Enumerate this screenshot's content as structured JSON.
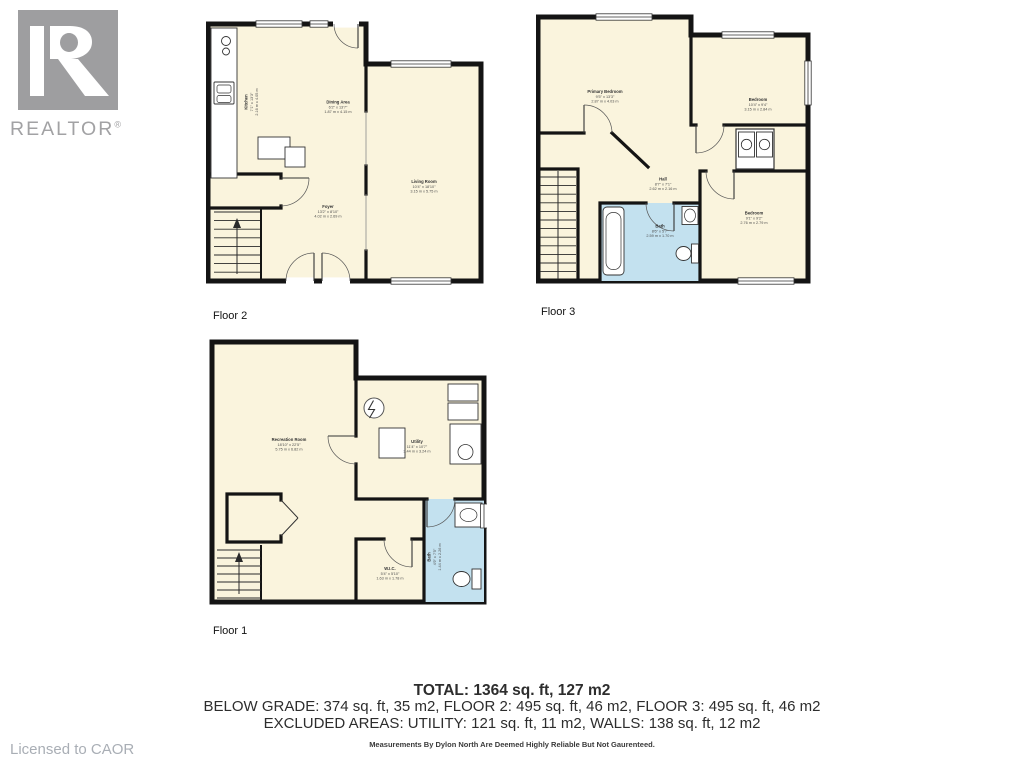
{
  "branding": {
    "logo_text": "REALTOR",
    "logo_reg": "®",
    "licensed": "Licensed to CAOR"
  },
  "floors": {
    "floor2": {
      "label": "Floor 2",
      "rooms": {
        "kitchen": {
          "name": "Kitchen",
          "ft": "7'1\" x 13'3\"",
          "m": "2.16 m x 4.05 m"
        },
        "dining": {
          "name": "Dining Area",
          "ft": "6'2\" x 13'7\"",
          "m": "1.87 m x 4.15 m"
        },
        "living": {
          "name": "Living Room",
          "ft": "10'4\" x 18'10\"",
          "m": "3.15 m x 5.75 m"
        },
        "foyer": {
          "name": "Foyer",
          "ft": "13'2\" x 8'10\"",
          "m": "4.02 m x 2.69 m"
        }
      }
    },
    "floor3": {
      "label": "Floor 3",
      "rooms": {
        "primary": {
          "name": "Primary Bedroom",
          "ft": "9'5\" x 13'3\"",
          "m": "2.87 m x 4.03 m"
        },
        "bedroom2": {
          "name": "Bedroom",
          "ft": "10'4\" x 9'4\"",
          "m": "3.15 m x 2.84 m"
        },
        "hall": {
          "name": "Hall",
          "ft": "8'7\" x 7'1\"",
          "m": "2.62 m x 2.16 m"
        },
        "bath": {
          "name": "Bath",
          "ft": "8'6\" x 5'7\"",
          "m": "2.59 m x 1.70 m"
        },
        "bedroom3": {
          "name": "Bedroom",
          "ft": "9'1\" x 9'2\"",
          "m": "2.76 m x 2.79 m"
        }
      }
    },
    "floor1": {
      "label": "Floor 1",
      "rooms": {
        "rec": {
          "name": "Recreation Room",
          "ft": "18'10\" x 22'5\"",
          "m": "5.75 m x 6.82 m"
        },
        "utility": {
          "name": "Utility",
          "ft": "11'4\" x 10'7\"",
          "m": "3.44 m x 3.24 m"
        },
        "wic": {
          "name": "W.I.C.",
          "ft": "5'4\" x 5'10\"",
          "m": "1.63 m x 1.78 m"
        },
        "bath": {
          "name": "Bath",
          "ft": "4'9\" x 7'5\"",
          "m": "1.44 m x 2.26 m"
        }
      }
    }
  },
  "summary": {
    "total": "TOTAL: 1364 sq. ft, 127 m2",
    "breakdown": "BELOW GRADE: 374 sq. ft, 35 m2, FLOOR 2: 495 sq. ft, 46 m2, FLOOR 3: 495 sq. ft, 46 m2",
    "excluded": "EXCLUDED AREAS: UTILITY: 121 sq. ft, 11 m2, WALLS: 138 sq. ft, 12 m2",
    "disclaimer": "Measurements By Dylon North Are Deemed Highly Reliable But Not Gaurenteed."
  },
  "colors": {
    "wall": "#141414",
    "room_fill": "#faf4dd",
    "bath_fill": "#c3e1ef",
    "logo_gray": "#9e9ea0",
    "summary_text": "#2d2d2d"
  }
}
